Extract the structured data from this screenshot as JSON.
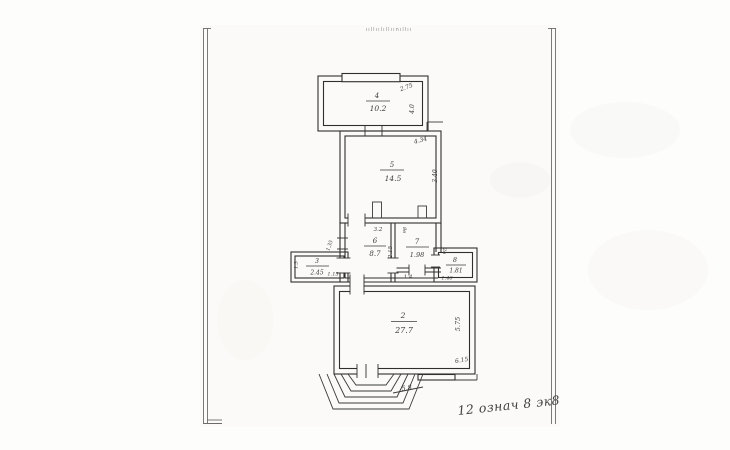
{
  "document": {
    "top_label": "ııllıılıllıınıllıı",
    "bottom_note": "12 означ 8 эк8"
  },
  "rooms": {
    "r2": {
      "num": "2",
      "area": "27.7"
    },
    "r3": {
      "num": "3",
      "area": "2.45"
    },
    "r4": {
      "num": "4",
      "area": "10.2"
    },
    "r5": {
      "num": "5",
      "area": "14.5"
    },
    "r6": {
      "num": "6",
      "area": "8.7"
    },
    "r7": {
      "num": "7",
      "area": "1.98"
    },
    "r8": {
      "num": "8",
      "area": "1.81"
    }
  },
  "dimensions": {
    "room4_width_dim": "2.75",
    "room4_side_dim": "4.0",
    "room5_width_dim": "4.34",
    "room5_side_dim": "3.40",
    "room6_top_dim": "3.2",
    "divider_dim": "2.15",
    "room7_bottom_dim": "1.4",
    "room7_door_mark": "8в",
    "room8_door_mark": "2в",
    "room8_bottom_dim": "1.46",
    "room3_bottom_dim": "1.15",
    "room3_side_dim": "1.3",
    "left_window_dim": "1.35",
    "room2_side_dim": "5.75",
    "room2_bottom_dim": "6.15",
    "porch_dim": "5.8"
  }
}
